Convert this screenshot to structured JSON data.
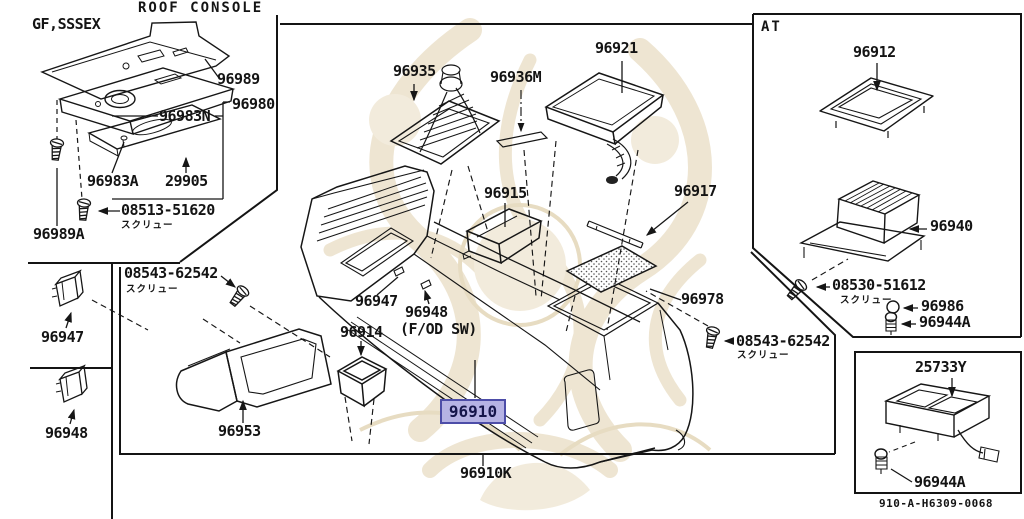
{
  "page": {
    "type": "exploded-parts-diagram",
    "highlight_color": "#b6b3e4",
    "highlight_border": "#4d4da8",
    "line_color": "#161616",
    "watermark_color": "#eadfc8"
  },
  "sections": {
    "roof_console": {
      "title": "ROOF CONSOLE",
      "variant": "GF,SSSEX"
    },
    "at": {
      "label": "AT"
    },
    "footer": {
      "diagram_code": "910-A-H6309-0068"
    }
  },
  "annotations": {
    "screw_jp": "スクリュー",
    "fod_sw": "(F/OD SW)"
  },
  "parts": {
    "p96989": "96989",
    "p96980": "96980",
    "p96983N": "96983N",
    "p96983A": "96983A",
    "p29905": "29905",
    "p08513_51620": "08513-51620",
    "p96989A": "96989A",
    "p96947": "96947",
    "p96948": "96948",
    "p08543_62542": "08543-62542",
    "p96935": "96935",
    "p96936M": "96936M",
    "p96921": "96921",
    "p96917": "96917",
    "p96915": "96915",
    "p96978": "96978",
    "p96914": "96914",
    "p96953": "96953",
    "p96910": "96910",
    "p96910K": "96910K",
    "p96912": "96912",
    "p96940": "96940",
    "p08530_51612": "08530-51612",
    "p96986": "96986",
    "p96944A": "96944A",
    "p25733Y": "25733Y"
  }
}
